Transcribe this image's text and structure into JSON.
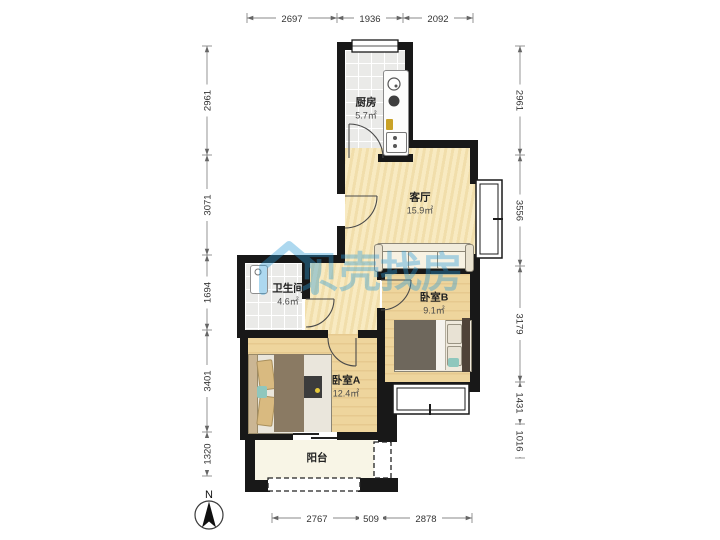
{
  "floorplan": {
    "rooms": [
      {
        "name": "厨房",
        "area": "5.7㎡"
      },
      {
        "name": "客厅",
        "area": "15.9㎡"
      },
      {
        "name": "卫生间",
        "area": "4.6㎡"
      },
      {
        "name": "卧室B",
        "area": "9.1㎡"
      },
      {
        "name": "卧室A",
        "area": "12.4㎡"
      },
      {
        "name": "阳台",
        "area": ""
      }
    ],
    "dimensions_mm": {
      "top": [
        "2697",
        "1936",
        "2092"
      ],
      "left": [
        "2961",
        "3071",
        "1694",
        "3401",
        "1320"
      ],
      "right": [
        "2961",
        "3556",
        "3179",
        "1431",
        "1016"
      ],
      "bottom": [
        "2767",
        "509",
        "2878"
      ]
    },
    "compass": {
      "label": "N"
    },
    "watermark": {
      "text": "贝壳找房",
      "color": "#2b9bd7"
    },
    "palette": {
      "wall": "#181818",
      "living_floor": "#f6e7ba",
      "wood_floor": "#eed59d",
      "tile_floor": "#eaeae8",
      "balcony_floor": "#f8f5e6"
    }
  }
}
